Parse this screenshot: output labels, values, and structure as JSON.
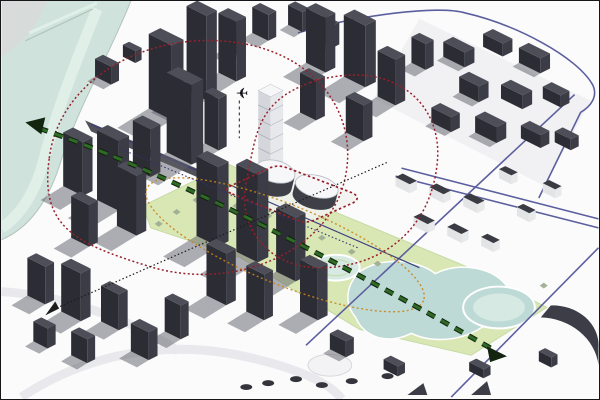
{
  "figure": {
    "type": "urban-design-axonometric-analysis-diagram",
    "description": "Axonometric massing study of a riverside city district: dark grey context buildings, a white highlighted development site (tower with curved podium), river at upper left, central green corridor with ponds, red dotted influence loops, orange dotted radius, green dashed view axis with arrowheads, black and navy dotted sight lines, indigo road lines, airplane marker.",
    "width": 600,
    "height": 400
  },
  "icons": {
    "airplane": "✈"
  },
  "colors": {
    "bg": "#fbfbfc",
    "frame": "#15151a",
    "water": "#cfe3dc",
    "waterLight": "#e1efe9",
    "bank": "#d7dbd9",
    "shore": "#b3c4bd",
    "parcel": "#ededf1",
    "roadDark": "#41424b",
    "faintRoad": "#e9e9ed",
    "bTop": "#4d4e58",
    "bLeft": "#2c2c34",
    "bRight": "#3b3c45",
    "shadow": "#5e5f68",
    "roofDark": "#3b3b44",
    "wallLight": "#e8e9eb",
    "wTop": "#f7f7f9",
    "wLeft": "#d5d6dc",
    "wRight": "#e7e8ec",
    "wEdge": "#b6bac2",
    "park": "#d9e7b4",
    "parkEdge": "#c6dba4",
    "pond": "#bedad6",
    "pondLight": "#d6e9e3",
    "tree": "#9fae93",
    "scrub": "#34343c",
    "red": "#97202a",
    "orange": "#c8841c",
    "greenAxis": "#2f6b27",
    "greenAxisDark": "#13240f",
    "black": "#1c1c1c",
    "navyDot": "#2e3170",
    "roadBlue": "#5c5f9e",
    "roadNavy": "#3c3e7e",
    "plane": "#0e0e12"
  },
  "scene": {
    "projection": {
      "ux": 0.894,
      "uy": 0.447,
      "vx": 0.894,
      "vy": -0.447
    },
    "river": {
      "water": "M0,0 L130,0 C108,55 78,105 60,160 C48,200 28,228 0,240 Z",
      "stripe": "M96,8 C76,58 56,108 43,158 C35,190 20,215 0,228",
      "bank": "M0,0 L46,0 C36,26 20,44 0,56 Z",
      "shoreline": "M130,0 C108,55 78,105 60,160 C48,200 28,228 0,240",
      "bridgeTop": "M28,32 L96,2",
      "bridgeEdge": "M24,40 L92,8"
    },
    "parcels": [
      "420,18 592,100 546,186 374,98"
    ],
    "faintRoads": [
      "M20,398 C90,352 170,340 248,358 C300,370 330,384 342,400",
      "M0,292 C60,296 128,318 178,352"
    ],
    "mainRoadDark": "84,120 90,131 350,243 344,232",
    "park": "M142,206 L228,164 L340,214 L470,268 L548,308 L472,356 L360,330 L240,258 L150,228 Z",
    "plaza": {
      "cx": 336,
      "cy": 268,
      "rx": 24,
      "ry": 13
    },
    "oval": {
      "cx": 330,
      "cy": 366,
      "rx": 22,
      "ry": 11
    },
    "pond": "M360,272 C384,256 418,260 436,274 C460,262 490,268 504,282 C518,296 510,314 490,322 C472,340 436,346 412,334 C388,346 364,338 356,318 C344,304 346,286 360,272 Z",
    "circlePond": {
      "cx": 500,
      "cy": 308,
      "rx": 36,
      "ry": 21,
      "irx": 26,
      "iry": 14
    },
    "roadsBlue": [
      "M298,32 C358,14 440,4 466,12 C518,24 578,56 594,84 C600,96 592,106 582,112 L540,198",
      "M402,168 L600,219",
      "M396,176 L600,228",
      "M576,94 L306,346",
      "M600,248 L452,398"
    ],
    "roadNavyLine": "M90,124 L420,268",
    "crescent": "M552,306 A46,40 0 0 1 600,348 L600,366 A60,54 0 0 0 542,318 Z",
    "darkTriangles": [
      "408,396 428,396 424,384",
      "472,396 492,396 488,382"
    ],
    "buildings": [
      [
        148,
        108,
        26,
        13,
        75,
        "d"
      ],
      [
        186,
        90,
        22,
        12,
        85,
        "d"
      ],
      [
        218,
        72,
        20,
        11,
        60,
        "d"
      ],
      [
        166,
        152,
        28,
        13,
        80,
        "d"
      ],
      [
        132,
        168,
        20,
        11,
        48,
        "d"
      ],
      [
        204,
        143,
        16,
        9,
        52,
        "d"
      ],
      [
        252,
        32,
        18,
        9,
        26,
        "d"
      ],
      [
        288,
        24,
        16,
        8,
        20,
        "d"
      ],
      [
        224,
        48,
        16,
        8,
        30,
        "d"
      ],
      [
        318,
        40,
        16,
        8,
        22,
        "d"
      ],
      [
        306,
        62,
        22,
        11,
        55,
        "d"
      ],
      [
        344,
        76,
        24,
        12,
        62,
        "d"
      ],
      [
        378,
        96,
        20,
        11,
        46,
        "d"
      ],
      [
        300,
        112,
        18,
        10,
        40,
        "d"
      ],
      [
        412,
        62,
        16,
        9,
        26,
        "d"
      ],
      [
        346,
        132,
        20,
        10,
        36,
        "d"
      ],
      [
        444,
        56,
        24,
        11,
        15,
        "d"
      ],
      [
        484,
        46,
        22,
        11,
        13,
        "d"
      ],
      [
        520,
        62,
        24,
        11,
        15,
        "d"
      ],
      [
        460,
        92,
        22,
        11,
        16,
        "d"
      ],
      [
        502,
        98,
        24,
        11,
        14,
        "d"
      ],
      [
        544,
        98,
        20,
        10,
        12,
        "d"
      ],
      [
        432,
        122,
        22,
        10,
        15,
        "d"
      ],
      [
        476,
        132,
        24,
        11,
        16,
        "d"
      ],
      [
        522,
        138,
        22,
        10,
        13,
        "d"
      ],
      [
        556,
        142,
        18,
        9,
        11,
        "d"
      ],
      [
        62,
        186,
        22,
        11,
        54,
        "d"
      ],
      [
        96,
        200,
        24,
        12,
        70,
        "d"
      ],
      [
        70,
        238,
        20,
        10,
        42,
        "d"
      ],
      [
        116,
        226,
        22,
        11,
        60,
        "d"
      ],
      [
        94,
        76,
        18,
        9,
        18,
        "d"
      ],
      [
        122,
        56,
        14,
        7,
        12,
        "d"
      ],
      [
        196,
        236,
        24,
        12,
        80,
        "d"
      ],
      [
        236,
        252,
        24,
        12,
        88,
        "d"
      ],
      [
        276,
        272,
        22,
        11,
        64,
        "d"
      ],
      [
        206,
        296,
        22,
        11,
        52,
        "d"
      ],
      [
        246,
        312,
        20,
        10,
        46,
        "d"
      ],
      [
        300,
        312,
        20,
        11,
        52,
        "d"
      ],
      [
        26,
        296,
        20,
        10,
        38,
        "d"
      ],
      [
        60,
        312,
        22,
        11,
        48,
        "d"
      ],
      [
        100,
        322,
        20,
        10,
        36,
        "d"
      ],
      [
        32,
        342,
        16,
        9,
        20,
        "d"
      ],
      [
        70,
        356,
        18,
        9,
        24,
        "d"
      ],
      [
        130,
        352,
        20,
        10,
        28,
        "d"
      ],
      [
        164,
        332,
        18,
        9,
        34,
        "d"
      ],
      [
        396,
        186,
        16,
        8,
        9,
        "r"
      ],
      [
        430,
        196,
        16,
        8,
        9,
        "r"
      ],
      [
        464,
        206,
        16,
        8,
        9,
        "r"
      ],
      [
        414,
        226,
        16,
        8,
        9,
        "r"
      ],
      [
        448,
        236,
        16,
        8,
        9,
        "r"
      ],
      [
        482,
        246,
        14,
        7,
        9,
        "r"
      ],
      [
        518,
        216,
        14,
        7,
        9,
        "r"
      ],
      [
        544,
        192,
        14,
        7,
        9,
        "r"
      ],
      [
        500,
        178,
        14,
        7,
        9,
        "r"
      ],
      [
        330,
        350,
        18,
        9,
        16,
        "d"
      ],
      [
        384,
        370,
        16,
        8,
        10,
        "d"
      ],
      [
        470,
        372,
        16,
        8,
        9,
        "d"
      ],
      [
        540,
        362,
        14,
        7,
        10,
        "d"
      ],
      [
        258,
        162,
        14,
        14,
        72,
        "w"
      ],
      [
        240,
        196,
        10,
        7,
        8,
        "w"
      ]
    ],
    "podiumBlobs": [
      {
        "cx": 272,
        "cy": 185,
        "rx": 20,
        "ry": 11,
        "h": 14,
        "rot": 14
      },
      {
        "cx": 314,
        "cy": 198,
        "rx": 22,
        "ry": 11,
        "h": 12,
        "rot": 14
      }
    ],
    "siteApron": "M232,194 L296,220 Q306,224 315,220 L353,203 Q362,198 353,193 L288,168 Q278,164 269,168 L230,186 Q222,190 232,194 Z",
    "trees": [
      [
        176,
        212
      ],
      [
        196,
        200
      ],
      [
        214,
        190
      ],
      [
        236,
        206
      ],
      [
        256,
        196
      ],
      [
        300,
        224
      ],
      [
        322,
        238
      ],
      [
        268,
        216
      ],
      [
        158,
        224
      ],
      [
        352,
        252
      ],
      [
        378,
        264
      ],
      [
        545,
        286
      ]
    ],
    "scrubs": [
      [
        268,
        384
      ],
      [
        296,
        380
      ],
      [
        352,
        382
      ],
      [
        388,
        377
      ],
      [
        246,
        388
      ],
      [
        322,
        386
      ]
    ],
    "annotations": {
      "siteBoundaryRed": "M232,194 L296,220 Q306,224 315,220 L353,203 Q362,198 353,193 L288,168 Q278,164 269,168 L230,186 Q222,190 232,194 Z",
      "redLoopWest": "M48,158 C58,78 148,28 238,42 C324,55 364,124 342,190 C318,258 226,292 146,266 C76,244 38,228 48,158 Z",
      "redLoopEast": "M310,82 C390,56 444,100 438,162 C432,226 388,264 328,268 C270,272 236,228 246,182 C256,134 256,102 310,82 Z",
      "orangeEllipse": {
        "cx": 285,
        "cy": 245,
        "rx": 150,
        "ry": 40,
        "rot": 22
      },
      "greenAxis": "M38,128 C150,166 300,240 497,352",
      "greenArrowStart": "24,122 44,117 40,134",
      "greenArrowEnd": "508,357 488,347 491,363",
      "blackSightLine": "M52,310 L388,162",
      "blackArrow": "44,316 58,309 54,302",
      "navySightLine": "M118,148 L358,248",
      "planePole": "M239,100 L239,138",
      "planePos": {
        "x": 248,
        "y": 98
      }
    }
  }
}
